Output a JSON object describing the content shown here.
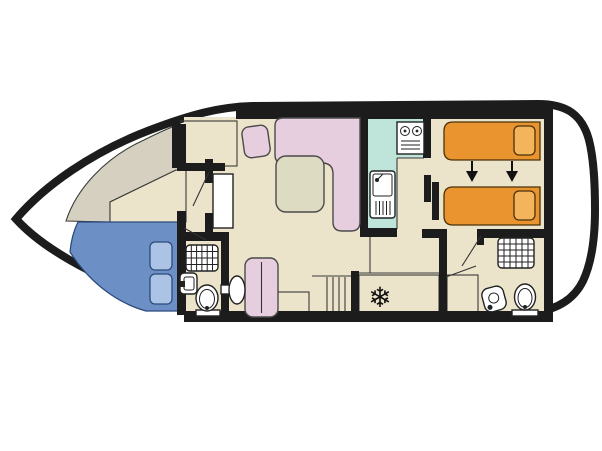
{
  "canvas": {
    "width": 602,
    "height": 451,
    "background": "#ffffff"
  },
  "colors": {
    "hull": "#1c1c1c",
    "deck": "#ffffff",
    "floor": "#ece4ca",
    "wall_shade": "#d5d0bf",
    "sofa_pink": "#e7cede",
    "table_top": "#dedbc3",
    "bed_blue": "#6c90c6",
    "pillow_blue": "#abc4e6",
    "bed_orange": "#e9942f",
    "pillow_orange": "#f3b45c",
    "counter_teal": "#bfe4da",
    "fridge_teal": "#d6eee6",
    "fixture_white": "#ffffff",
    "line_dark": "#222222"
  },
  "icons": {
    "snowflake": "❄"
  },
  "structure": {
    "type": "boat-floorplan",
    "areas": [
      {
        "name": "bow-cabin",
        "items": [
          "double-bed",
          "pillow",
          "pillow",
          "wardrobe"
        ]
      },
      {
        "name": "forward-bathroom",
        "items": [
          "shower",
          "washbasin",
          "toilet"
        ]
      },
      {
        "name": "saloon",
        "items": [
          "l-shaped-sofa",
          "corner-seat",
          "table",
          "bench-seat",
          "pedestal-table",
          "steps",
          "cabinet"
        ]
      },
      {
        "name": "galley",
        "items": [
          "stove",
          "sink-with-drainer",
          "fridge"
        ]
      },
      {
        "name": "aft-cabin",
        "items": [
          "single-bed",
          "single-bed",
          "convert-arrow",
          "convert-arrow"
        ]
      },
      {
        "name": "aft-bathroom",
        "items": [
          "shower",
          "washbasin",
          "toilet"
        ]
      },
      {
        "name": "stern-deck",
        "items": []
      }
    ]
  }
}
